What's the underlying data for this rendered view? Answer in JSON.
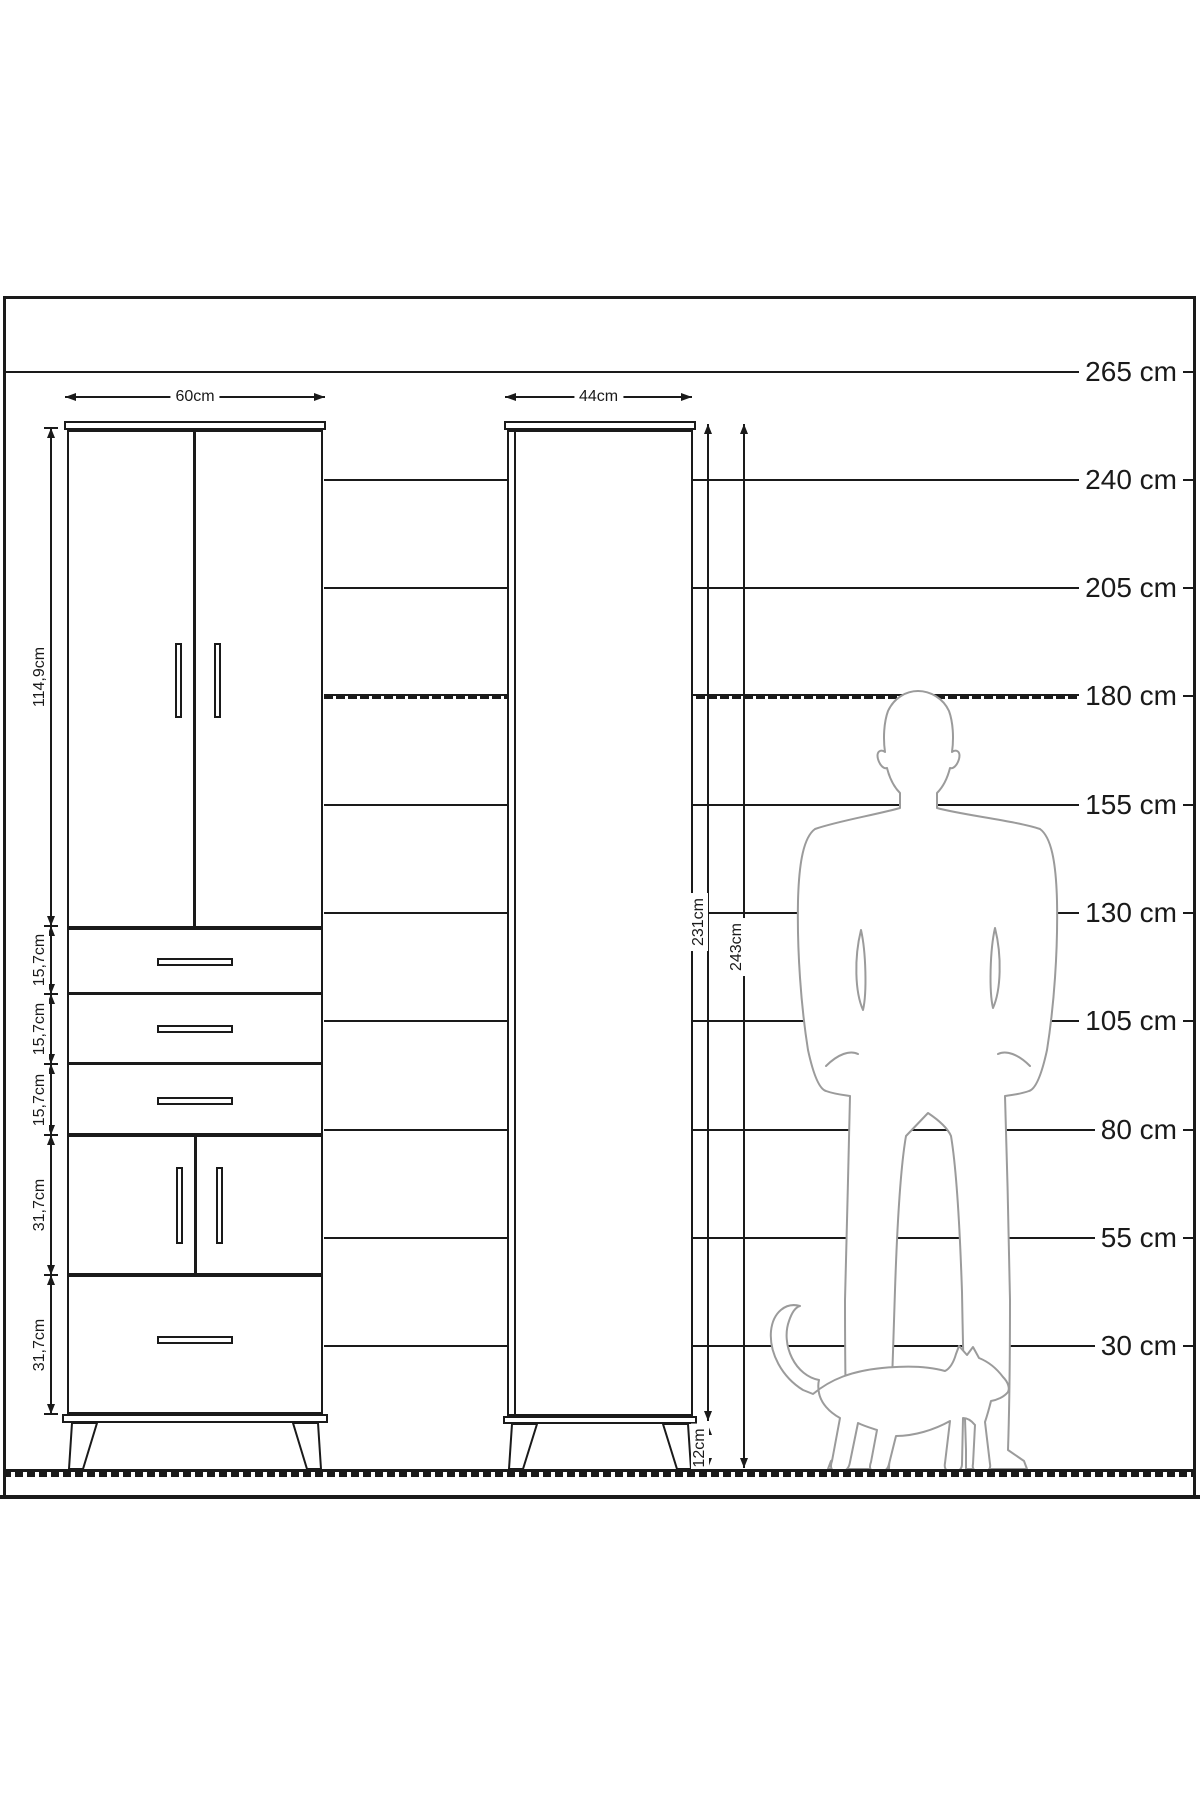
{
  "meta": {
    "type": "furniture-dimension-diagram",
    "background": "#ffffff",
    "line_color": "#1a1a1a",
    "silhouette_color": "#9b9b9b"
  },
  "height_scale": {
    "unit": "cm",
    "rows": [
      {
        "label": "265 cm",
        "y": 372,
        "x_start": 3,
        "dashed": false
      },
      {
        "label": "240 cm",
        "y": 480,
        "x_start": 324,
        "dashed": false
      },
      {
        "label": "205 cm",
        "y": 588,
        "x_start": 324,
        "dashed": false
      },
      {
        "label": "180 cm",
        "y": 696,
        "x_start": 324,
        "dashed": true
      },
      {
        "label": "155 cm",
        "y": 805,
        "x_start": 324,
        "dashed": false
      },
      {
        "label": "130 cm",
        "y": 913,
        "x_start": 324,
        "dashed": false
      },
      {
        "label": "105 cm",
        "y": 1021,
        "x_start": 324,
        "dashed": false
      },
      {
        "label": "80 cm",
        "y": 1130,
        "x_start": 324,
        "dashed": false
      },
      {
        "label": "55 cm",
        "y": 1238,
        "x_start": 324,
        "dashed": false
      },
      {
        "label": "30 cm",
        "y": 1346,
        "x_start": 324,
        "dashed": false
      }
    ]
  },
  "tall_cabinet": {
    "width_dim": {
      "label": "60cm",
      "y": 397,
      "from": 65,
      "to": 325
    },
    "chain_x": 51,
    "section_dims": [
      {
        "name": "upper-doors",
        "label": "114,9cm",
        "from": 428,
        "to": 926
      },
      {
        "name": "drawer-1",
        "label": "15,7cm",
        "from": 926,
        "to": 994
      },
      {
        "name": "drawer-2",
        "label": "15,7cm",
        "from": 994,
        "to": 1064
      },
      {
        "name": "drawer-3",
        "label": "15,7cm",
        "from": 1064,
        "to": 1135
      },
      {
        "name": "lower-doors",
        "label": "31,7cm",
        "from": 1135,
        "to": 1275
      },
      {
        "name": "bottom-drawer",
        "label": "31,7cm",
        "from": 1275,
        "to": 1414
      }
    ]
  },
  "slim_cabinet": {
    "width_dim": {
      "label": "44cm",
      "y": 397,
      "from": 505,
      "to": 692
    },
    "vertical_dims": [
      {
        "name": "body-height",
        "label": "231cm",
        "x": 708,
        "from": 424,
        "to": 1421,
        "label_cx": 699,
        "label_cy": 922
      },
      {
        "name": "total-height",
        "label": "243cm",
        "x": 744,
        "from": 424,
        "to": 1468,
        "label_cx": 737,
        "label_cy": 947
      },
      {
        "name": "leg-height",
        "label": "12cm",
        "x": 708,
        "from": 1425,
        "to": 1468,
        "label_cx": 700,
        "label_cy": 1448
      }
    ]
  },
  "silhouettes": {
    "man": "man-silhouette",
    "cat": "cat-silhouette"
  }
}
